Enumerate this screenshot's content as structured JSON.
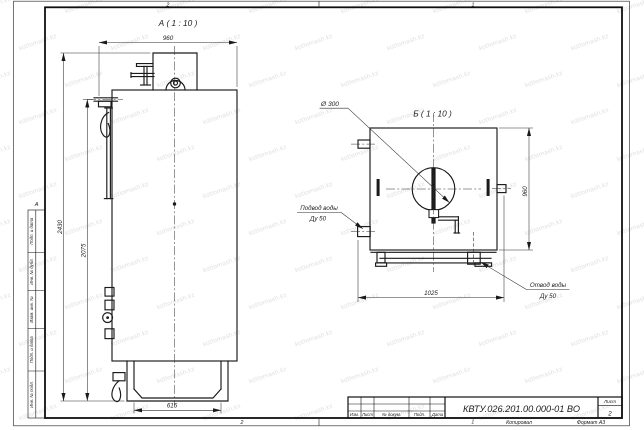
{
  "sheet": {
    "zones": {
      "top_left": "2",
      "top_right": "1",
      "bottom_left": "2",
      "bottom_right": "1",
      "left_letter": "А"
    },
    "footer": {
      "copied_label": "Копировал",
      "format_label": "Формат А3"
    }
  },
  "side_stamp": {
    "labels": [
      "Подп. и дата",
      "Инв. № дубл.",
      "Взам. инв. №",
      "Подп. и дата",
      "Инв. № подл."
    ]
  },
  "title_block": {
    "doc_number": "КВТУ.026.201.00.000-01 ВО",
    "sheet_label": "Лист",
    "sheet_number": "2",
    "columns": [
      "Изм.",
      "Лист",
      "№ докум.",
      "Подп.",
      "Дата"
    ]
  },
  "view_a": {
    "title": "А ( 1 : 10 )",
    "dim_width": "960",
    "dim_height_total": "2430",
    "dim_height_body": "2075",
    "dim_base": "615"
  },
  "view_b": {
    "title": "Б ( 1 : 10 )",
    "diameter_label": "Ø 300",
    "dim_height": "960",
    "dim_width": "1025",
    "inlet_label": "Подвод воды",
    "inlet_size": "Ду 50",
    "outlet_label": "Отвод воды",
    "outlet_size": "Ду 50"
  },
  "watermark": {
    "text": "kotlomash.kz",
    "color": "#dcdcdc"
  },
  "colors": {
    "line": "#1a1a1a",
    "background": "#ffffff"
  }
}
